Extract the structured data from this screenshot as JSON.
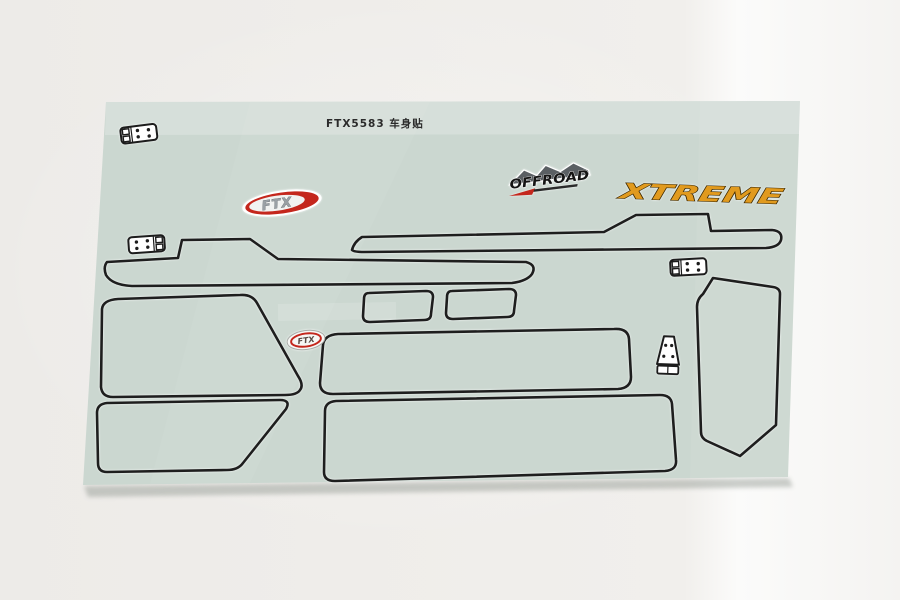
{
  "sheet": {
    "label": "FTX5583 车身贴"
  },
  "logos": {
    "ftx": "FTX",
    "ftx_small": "FTX",
    "offroad": "OFFROAD",
    "xtreme": "XTREME"
  },
  "colors": {
    "background": "#f1efec",
    "sheet": "#cbd7d0",
    "outline": "#1e1e1e",
    "ftx_red": "#c4271d",
    "xtreme_orange": "#e19a1e",
    "offroad_gray": "#5a5f63"
  }
}
